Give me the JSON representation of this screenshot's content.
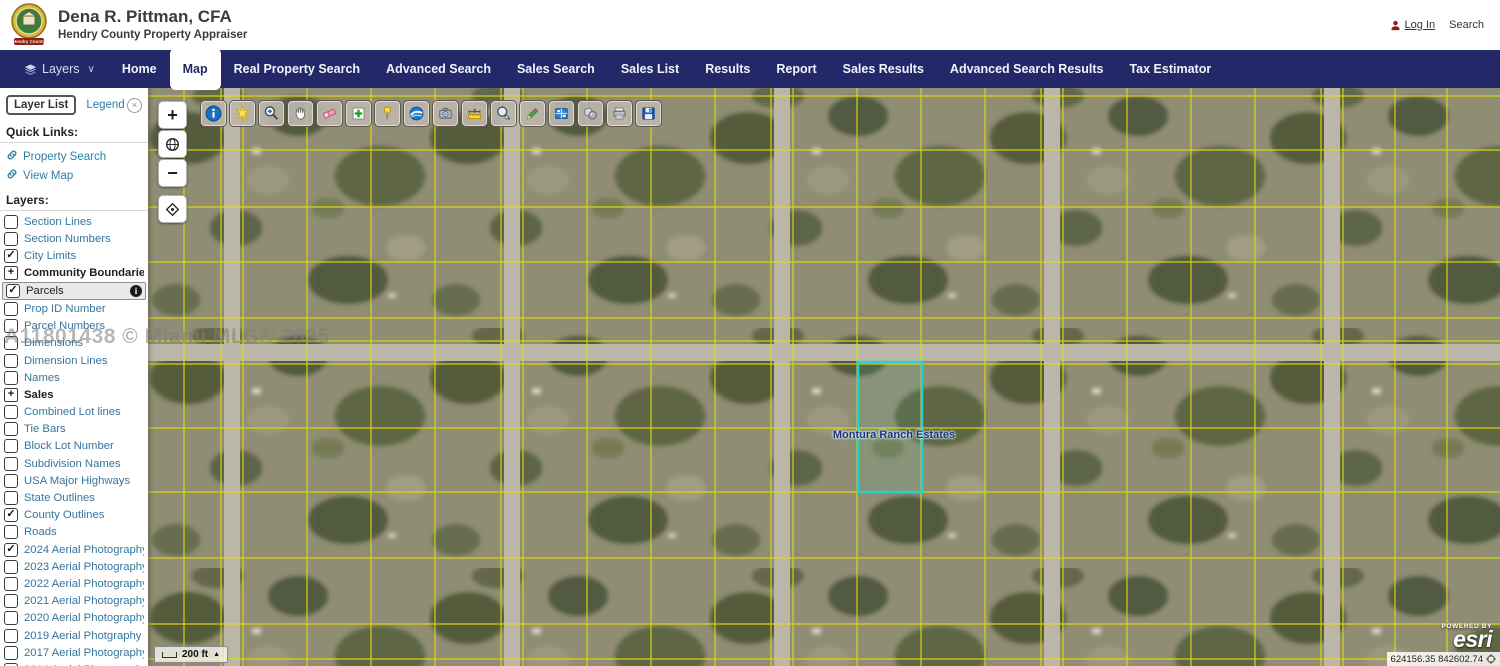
{
  "header": {
    "title": "Dena R. Pittman, CFA",
    "subtitle": "Hendry County Property Appraiser",
    "logo_ribbon": "Hendry County",
    "login_label": "Log In",
    "search_label": "Search"
  },
  "nav": {
    "layers_label": "Layers",
    "items": [
      {
        "label": "Home"
      },
      {
        "label": "Map",
        "active": true
      },
      {
        "label": "Real Property Search"
      },
      {
        "label": "Advanced Search"
      },
      {
        "label": "Sales Search"
      },
      {
        "label": "Sales List"
      },
      {
        "label": "Results"
      },
      {
        "label": "Report"
      },
      {
        "label": "Sales Results"
      },
      {
        "label": "Advanced Search Results"
      },
      {
        "label": "Tax Estimator"
      }
    ]
  },
  "sidebar": {
    "tab_layer_list": "Layer List",
    "tab_legend": "Legend",
    "quick_links_heading": "Quick Links:",
    "quick_links": [
      "Property Search",
      "View Map"
    ],
    "layers_heading": "Layers:",
    "layers": [
      {
        "label": "Section Lines"
      },
      {
        "label": "Section Numbers"
      },
      {
        "label": "City Limits",
        "checked": true
      },
      {
        "label": "Community Boundaries",
        "expand": true,
        "bold": true
      },
      {
        "label": "Parcels",
        "checked": true,
        "highlighted": true,
        "info": true
      },
      {
        "label": "Prop ID Number"
      },
      {
        "label": "Parcel Numbers"
      },
      {
        "label": "Dimensions"
      },
      {
        "label": "Dimension Lines"
      },
      {
        "label": "Names"
      },
      {
        "label": "Sales",
        "expand": true,
        "bold": true
      },
      {
        "label": "Combined Lot lines"
      },
      {
        "label": "Tie Bars"
      },
      {
        "label": "Block Lot Number"
      },
      {
        "label": "Subdivision Names"
      },
      {
        "label": "USA Major Highways"
      },
      {
        "label": "State Outlines"
      },
      {
        "label": "County Outlines",
        "checked": true
      },
      {
        "label": "Roads"
      },
      {
        "label": "2024 Aerial Photography",
        "checked": true
      },
      {
        "label": "2023 Aerial Photography"
      },
      {
        "label": "2022 Aerial Photography"
      },
      {
        "label": "2021 Aerial Photography"
      },
      {
        "label": "2020 Aerial Photography"
      },
      {
        "label": "2019 Aerial Photgraphy"
      },
      {
        "label": "2017 Aerial Photography"
      },
      {
        "label": "2014 Aerial Photography"
      },
      {
        "label": ""
      }
    ]
  },
  "map": {
    "toolbar": [
      "info-icon",
      "flash-icon",
      "zoom-in-tool-icon",
      "pan-icon",
      "eraser-icon",
      "add-icon",
      "pushpin-icon",
      "google-earth-icon",
      "camera-icon",
      "measure-icon",
      "search-magnifier-icon",
      "draw-icon",
      "extent-icon",
      "buffer-icon",
      "print-icon",
      "save-icon"
    ],
    "zoom_in_label": "+",
    "zoom_out_label": "−",
    "watermark": "A11801438 © Miami MLS® 2025",
    "parcel_label": "Montura Ranch Estates",
    "scale_label": "200 ft",
    "powered_by": "POWERED BY",
    "esri_label": "esri",
    "coordinates": "624156.35 842602.74"
  },
  "colors": {
    "nav_bg": "#232968",
    "link_blue": "#2f7ea8",
    "parcel_yellow": "#e4dd05",
    "highlight_cyan": "#2ad0d0",
    "map_base": "#8f8d73"
  }
}
